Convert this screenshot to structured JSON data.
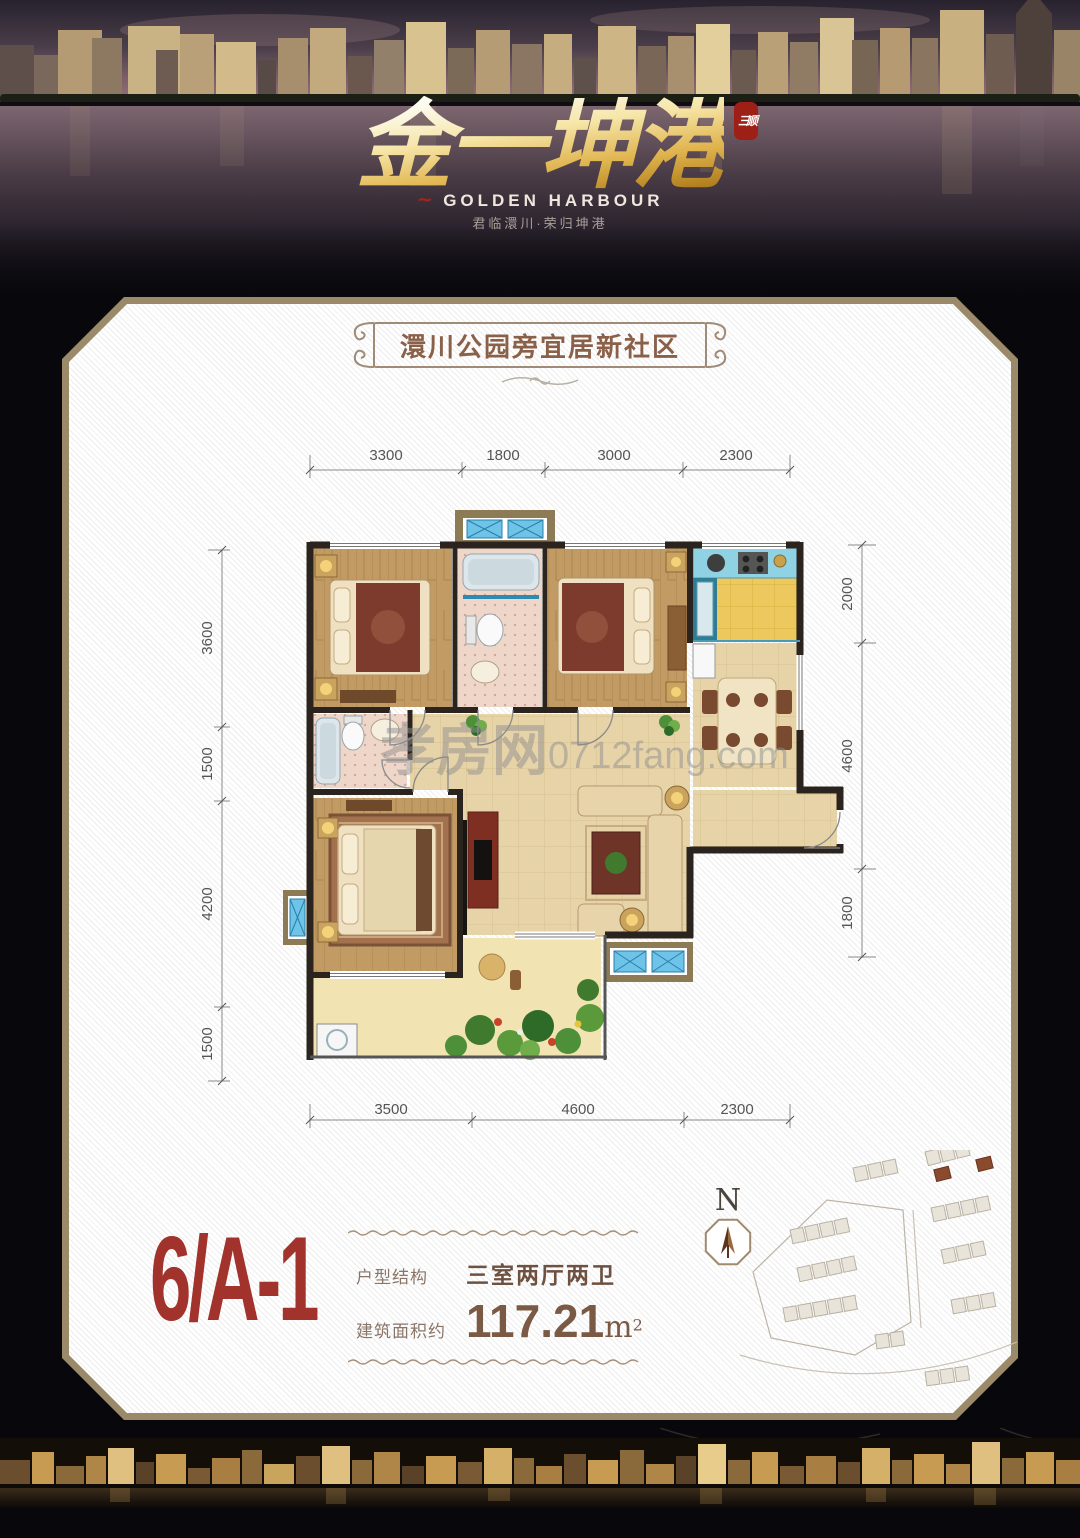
{
  "hero": {
    "logo_main": "金一坤港",
    "logo_seal": "三顺",
    "logo_en": "GOLDEN HARBOUR",
    "logo_tagline": "君临澴川·荣归坤港"
  },
  "banner": {
    "title": "澴川公园旁宜居新社区"
  },
  "plan": {
    "dims_top": [
      "3300",
      "1800",
      "3000",
      "2300"
    ],
    "dims_left": [
      "3600",
      "1500",
      "4200",
      "1500"
    ],
    "dims_right": [
      "2000",
      "4600",
      "1800"
    ],
    "dims_bottom": [
      "3500",
      "4600",
      "2300"
    ],
    "watermark_name": "孝房网",
    "watermark_url": "0712fang.com"
  },
  "info": {
    "unit_code": "6/A-1",
    "structure_label": "户型结构",
    "structure_value": "三室两厅两卫",
    "area_label": "建筑面积约",
    "area_number": "117.21",
    "area_unit": "m",
    "area_exponent": "2",
    "compass_letter": "N"
  },
  "colors": {
    "accent_red": "#a1322c",
    "text_brown": "#6e5140",
    "panel_border": "#9a8a6a",
    "gold": "#e0b44e",
    "window_blue": "#6ec3e8"
  }
}
